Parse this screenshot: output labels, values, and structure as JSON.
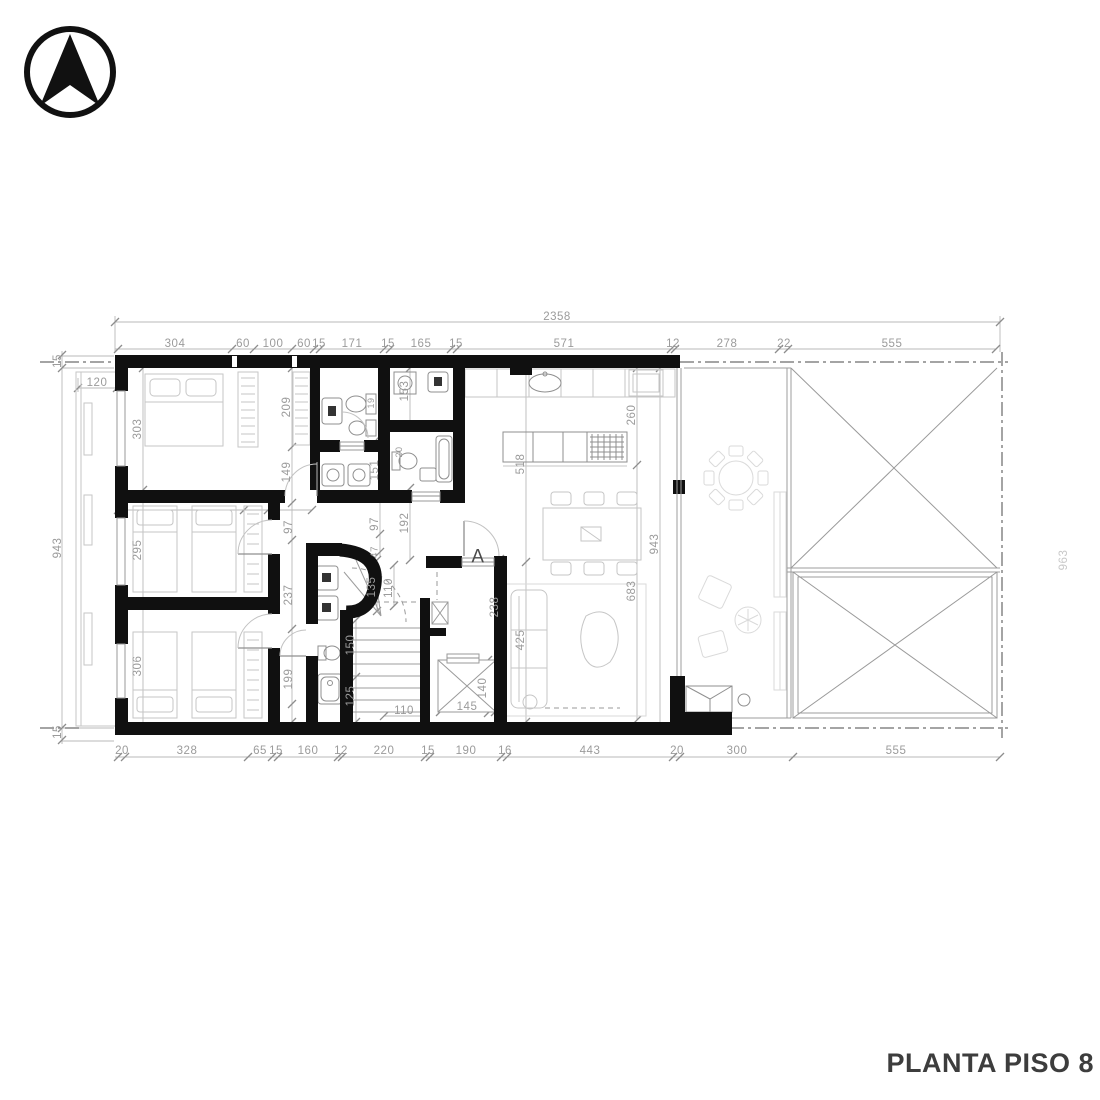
{
  "title": "PLANTA PISO 8",
  "logo": {
    "icon": "north-arrow"
  },
  "drawing": {
    "type": "architectural-floor-plan",
    "floor": "Piso 8"
  },
  "dimension_chains": {
    "overall_width": "2358",
    "top_row": [
      "304",
      "60",
      "100",
      "60",
      "15",
      "171",
      "15",
      "165",
      "15",
      "571",
      "12",
      "278",
      "22",
      "555"
    ],
    "bottom_row": [
      "20",
      "328",
      "65",
      "15",
      "160",
      "12",
      "220",
      "15",
      "190",
      "16",
      "443",
      "20",
      "300",
      "555"
    ],
    "left_column": [
      "15",
      "943",
      "15"
    ],
    "left_room_heights": [
      "303",
      "295",
      "306"
    ],
    "balcony_width": "120",
    "right_interior": [
      "260",
      "683",
      "943",
      "518",
      "425",
      "238"
    ],
    "interior": [
      "209",
      "149",
      "151",
      "153",
      "19",
      "97",
      "97",
      "47",
      "192",
      "336",
      "65",
      "237",
      "199",
      "135",
      "110",
      "150",
      "125",
      "110",
      "145",
      "140",
      "20"
    ],
    "right_edge_clipped": "963",
    "section_marker": "A"
  },
  "plan": {
    "dim_color": "#9b9b9b",
    "labels": [
      {
        "t": "2358",
        "x": 557,
        "y": 316
      },
      {
        "t": "304",
        "x": 175,
        "y": 343
      },
      {
        "t": "60",
        "x": 243,
        "y": 343
      },
      {
        "t": "100",
        "x": 273,
        "y": 343
      },
      {
        "t": "60",
        "x": 304,
        "y": 343
      },
      {
        "t": "15",
        "x": 319,
        "y": 343
      },
      {
        "t": "171",
        "x": 352,
        "y": 343
      },
      {
        "t": "15",
        "x": 388,
        "y": 343
      },
      {
        "t": "165",
        "x": 421,
        "y": 343
      },
      {
        "t": "15",
        "x": 456,
        "y": 343
      },
      {
        "t": "571",
        "x": 564,
        "y": 343
      },
      {
        "t": "12",
        "x": 673,
        "y": 343
      },
      {
        "t": "278",
        "x": 727,
        "y": 343
      },
      {
        "t": "22",
        "x": 784,
        "y": 343
      },
      {
        "t": "555",
        "x": 892,
        "y": 343
      },
      {
        "t": "20",
        "x": 122,
        "y": 750
      },
      {
        "t": "328",
        "x": 187,
        "y": 750
      },
      {
        "t": "65",
        "x": 260,
        "y": 750
      },
      {
        "t": "15",
        "x": 276,
        "y": 750
      },
      {
        "t": "160",
        "x": 308,
        "y": 750
      },
      {
        "t": "12",
        "x": 341,
        "y": 750
      },
      {
        "t": "220",
        "x": 384,
        "y": 750
      },
      {
        "t": "15",
        "x": 428,
        "y": 750
      },
      {
        "t": "190",
        "x": 466,
        "y": 750
      },
      {
        "t": "16",
        "x": 505,
        "y": 750
      },
      {
        "t": "443",
        "x": 590,
        "y": 750
      },
      {
        "t": "20",
        "x": 677,
        "y": 750
      },
      {
        "t": "300",
        "x": 737,
        "y": 750
      },
      {
        "t": "555",
        "x": 896,
        "y": 750
      },
      {
        "t": "120",
        "x": 97,
        "y": 382
      },
      {
        "t": "15",
        "x": 57,
        "y": 361,
        "r": -90
      },
      {
        "t": "943",
        "x": 57,
        "y": 548,
        "r": -90
      },
      {
        "t": "15",
        "x": 57,
        "y": 732,
        "r": -90
      },
      {
        "t": "303",
        "x": 137,
        "y": 429,
        "r": -90
      },
      {
        "t": "295",
        "x": 137,
        "y": 550,
        "r": -90
      },
      {
        "t": "306",
        "x": 137,
        "y": 666,
        "r": -90
      },
      {
        "t": "209",
        "x": 286,
        "y": 407,
        "r": -90
      },
      {
        "t": "149",
        "x": 286,
        "y": 472,
        "r": -90
      },
      {
        "t": "97",
        "x": 288,
        "y": 527,
        "r": -90
      },
      {
        "t": "237",
        "x": 288,
        "y": 595,
        "r": -90
      },
      {
        "t": "199",
        "x": 288,
        "y": 679,
        "r": -90
      },
      {
        "t": "151",
        "x": 374,
        "y": 470,
        "r": -90
      },
      {
        "t": "97",
        "x": 374,
        "y": 524,
        "r": -90
      },
      {
        "t": "47",
        "x": 374,
        "y": 552,
        "r": -90,
        "s": 10
      },
      {
        "t": "153",
        "x": 404,
        "y": 391,
        "r": -90
      },
      {
        "t": "192",
        "x": 404,
        "y": 523,
        "r": -90
      },
      {
        "t": "19",
        "x": 371,
        "y": 403,
        "r": -90,
        "s": 9
      },
      {
        "t": "20",
        "x": 399,
        "y": 452,
        "r": -90,
        "s": 9
      },
      {
        "t": "135",
        "x": 371,
        "y": 587,
        "r": -90
      },
      {
        "t": "110",
        "x": 388,
        "y": 588,
        "r": -90
      },
      {
        "t": "150",
        "x": 350,
        "y": 645,
        "r": -90
      },
      {
        "t": "125",
        "x": 350,
        "y": 696,
        "r": -90
      },
      {
        "t": "110",
        "x": 404,
        "y": 710
      },
      {
        "t": "145",
        "x": 467,
        "y": 706
      },
      {
        "t": "140",
        "x": 482,
        "y": 688,
        "r": -90
      },
      {
        "t": "238",
        "x": 494,
        "y": 607,
        "r": -90
      },
      {
        "t": "518",
        "x": 520,
        "y": 464,
        "r": -90
      },
      {
        "t": "425",
        "x": 520,
        "y": 640,
        "r": -90
      },
      {
        "t": "260",
        "x": 631,
        "y": 415,
        "r": -90
      },
      {
        "t": "683",
        "x": 631,
        "y": 591,
        "r": -90
      },
      {
        "t": "943",
        "x": 654,
        "y": 544,
        "r": -90
      },
      {
        "t": "963",
        "x": 1063,
        "y": 560,
        "r": -90,
        "c": "#c8c8c8"
      },
      {
        "t": "A",
        "x": 478,
        "y": 556,
        "s": 19,
        "c": "#4a4a4a",
        "n": "section-marker-a"
      }
    ]
  }
}
